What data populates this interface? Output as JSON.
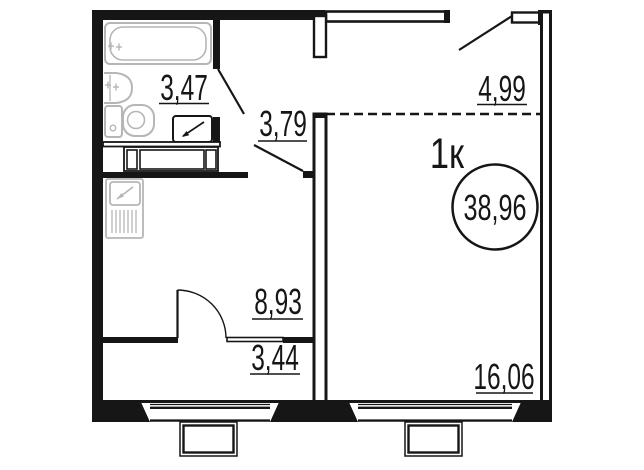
{
  "plan": {
    "unit_type_label": "1к",
    "total_area": "38,96",
    "rooms": {
      "bathroom": "3,47",
      "hallway": "3,79",
      "entry_zone": "4,99",
      "kitchen": "8,93",
      "storage": "3,44",
      "living_room": "16,06"
    },
    "colors": {
      "wall": "#161616",
      "fixture": "#b6b6b6",
      "background": "#ffffff"
    },
    "fixtures": [
      "bathtub",
      "sink",
      "toilet",
      "washing-machine",
      "kitchen-stove",
      "wardrobe"
    ]
  }
}
